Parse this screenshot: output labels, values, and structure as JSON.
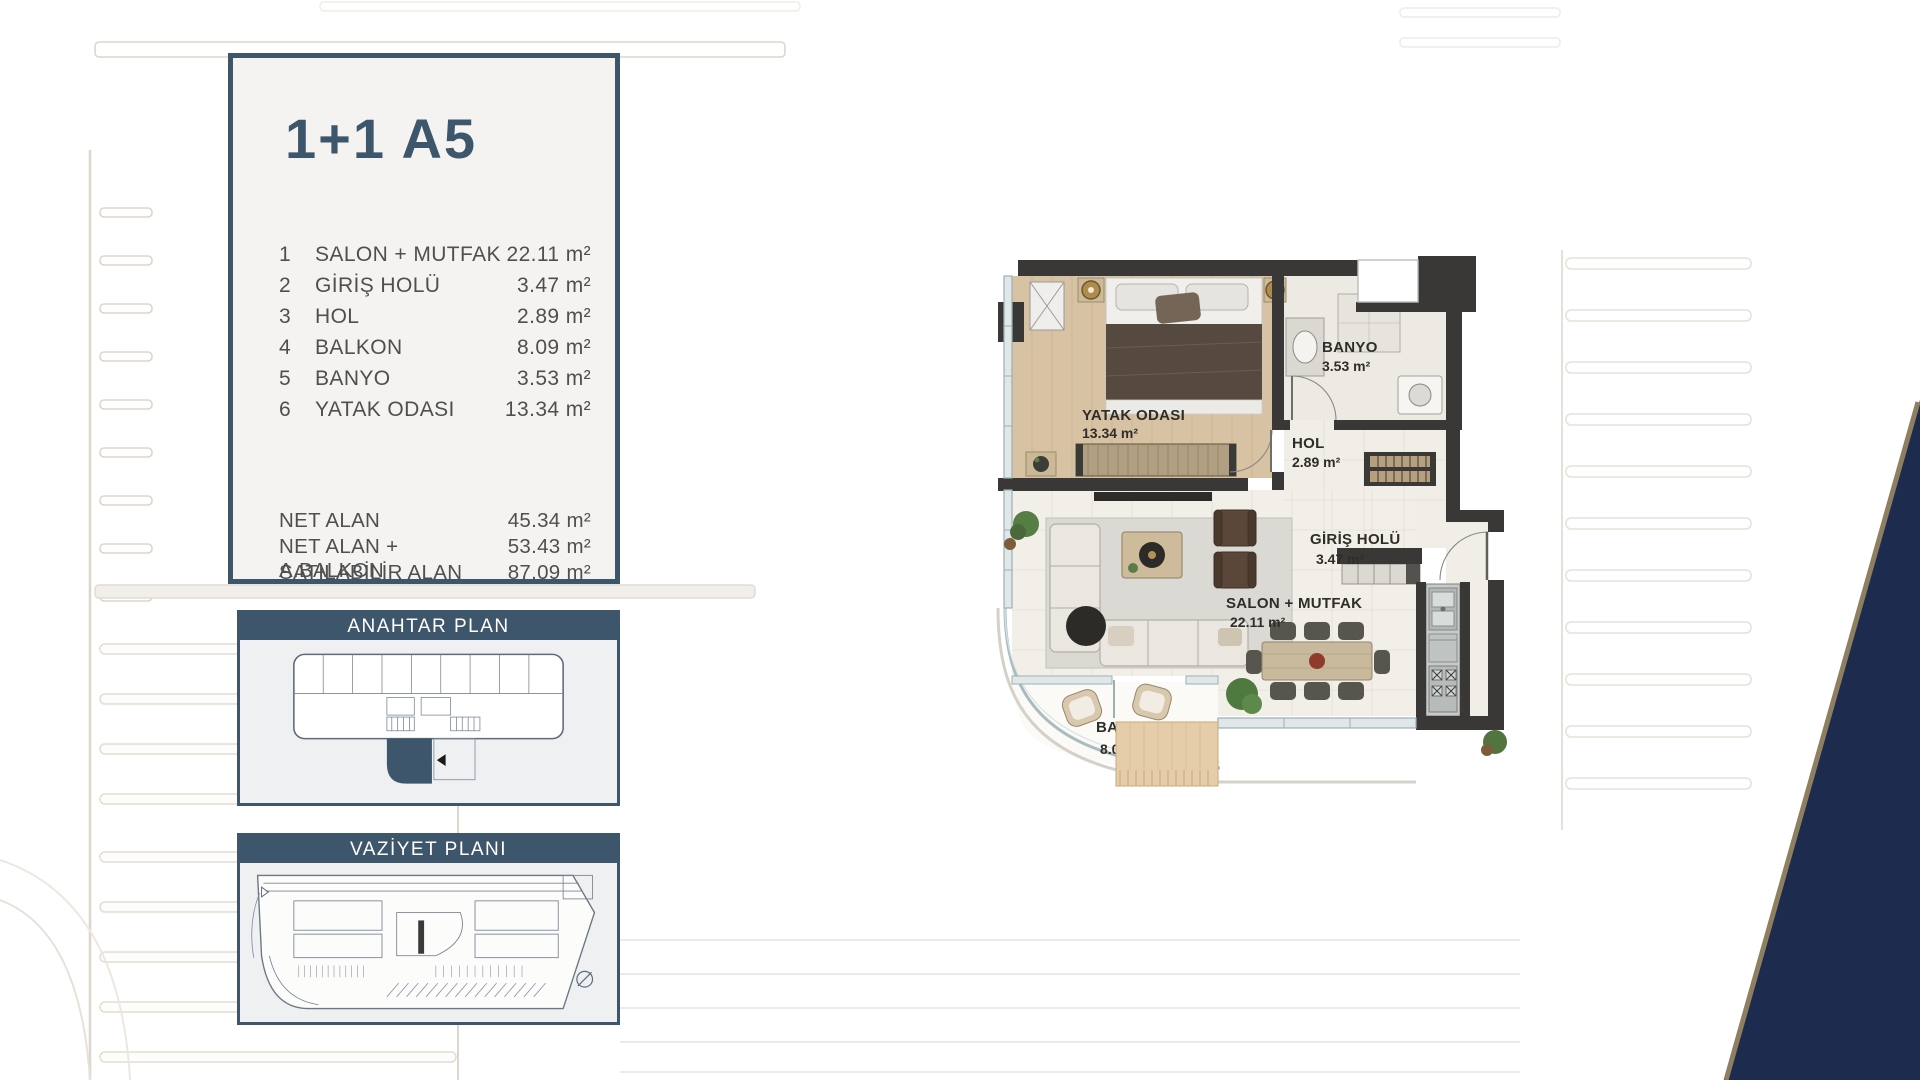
{
  "colors": {
    "accent_slate": "#3e566b",
    "navy_wedge": "#1d2b4e",
    "tan_edge": "#8d7f60",
    "plan_wall": "#393836"
  },
  "info_panel": {
    "title": "1+1 A5",
    "rooms": [
      {
        "no": "1",
        "label": "SALON + MUTFAK",
        "area": "22.11 m²"
      },
      {
        "no": "2",
        "label": "GİRİŞ HOLÜ",
        "area": "3.47 m²"
      },
      {
        "no": "3",
        "label": "HOL",
        "area": "2.89 m²"
      },
      {
        "no": "4",
        "label": "BALKON",
        "area": "8.09 m²"
      },
      {
        "no": "5",
        "label": "BANYO",
        "area": "3.53 m²"
      },
      {
        "no": "6",
        "label": "YATAK ODASI",
        "area": "13.34 m²"
      }
    ],
    "totals": [
      {
        "label": "NET ALAN",
        "area": "45.34 m²"
      },
      {
        "label": "NET ALAN + A.BALKON",
        "area": "53.43 m²"
      },
      {
        "label": "SATILABİLİR ALAN",
        "area": "87.09 m²"
      }
    ]
  },
  "key_plan": {
    "title": "ANAHTAR PLAN"
  },
  "site_plan": {
    "title": "VAZİYET PLANI"
  },
  "floor_plan": {
    "labels": {
      "bedroom": {
        "name": "YATAK ODASI",
        "area": "13.34 m²"
      },
      "bathroom": {
        "name": "BANYO",
        "area": "3.53 m²"
      },
      "hall": {
        "name": "HOL",
        "area": "2.89 m²"
      },
      "entrance": {
        "name": "GİRİŞ HOLÜ",
        "area": "3.47 m²"
      },
      "living": {
        "name": "SALON + MUTFAK",
        "area": "22.11 m²"
      },
      "balcony": {
        "name": "BALKON",
        "area": "8.0"
      }
    }
  }
}
